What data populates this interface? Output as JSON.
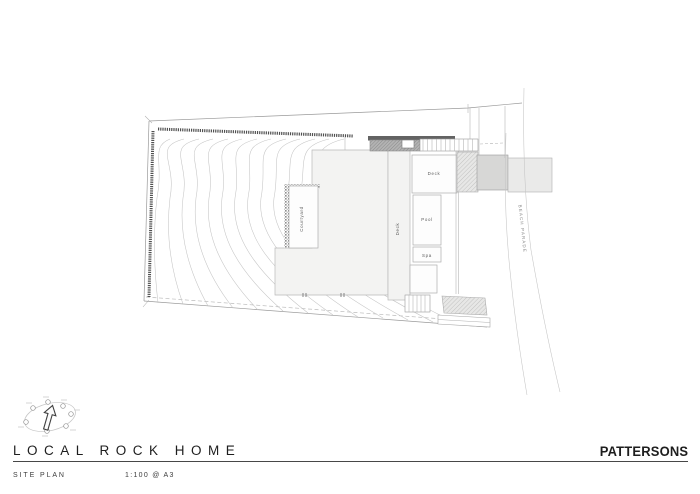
{
  "titleblock": {
    "project_title": "LOCAL ROCK HOME",
    "drawing_title": "SITE PLAN",
    "scale": "1:100 @ A3",
    "firm": "PATTERSONS"
  },
  "plan": {
    "labels": {
      "courtyard": "Courtyard",
      "deck_strip": "Deck",
      "deck_room": "Deck",
      "pool": "Pool",
      "spa": "Spa"
    },
    "street_name": "BEACH PARADE"
  },
  "icons": {
    "north_arrow": "north-arrow-sun-path-icon"
  },
  "colors": {
    "page_bg": "#ffffff",
    "line_light": "#c4c4c4",
    "line_mid": "#9a9a9a",
    "wall_dark": "#4f4f4f",
    "roof_fill": "#f3f3f2",
    "pad_gray": "#d7d7d6",
    "pad_light": "#eaeae9",
    "label_text": "#5a5a5a",
    "title_text": "#1e1e1e"
  }
}
